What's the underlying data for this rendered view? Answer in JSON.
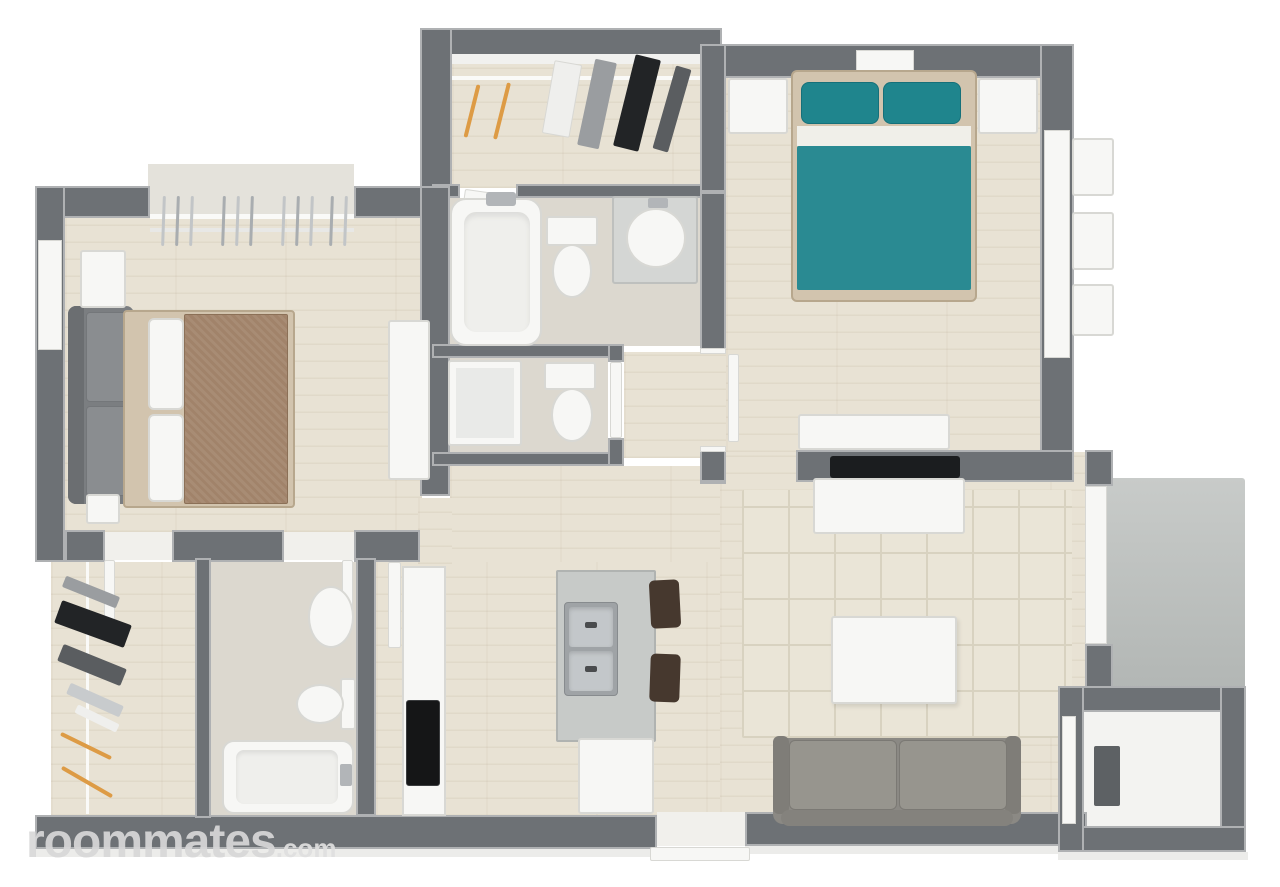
{
  "watermark": {
    "brand": "roommates",
    "suffix": ".com"
  },
  "plan": {
    "style": "3d-top-down-floorplan",
    "rooms": [
      "bedroom-1",
      "bedroom-2",
      "bathroom-1",
      "toilet-room",
      "bathroom-2",
      "walk-in-closet-1",
      "walk-in-closet-2",
      "kitchen",
      "living-room",
      "hallway",
      "patio",
      "storage-room"
    ]
  },
  "colors": {
    "wall": "#6d7175",
    "wallEdge": "rgba(255,255,255,0.45)",
    "woodBase": "#e8e2d4",
    "woodStreak": "rgba(155,135,105,0.10)",
    "bathFloor": "#dcd8cf",
    "alcoveFloor": "#e4e2db",
    "white": "#f7f7f5",
    "whiteBorder": "#d8d8d4",
    "teal": "#2a8a92",
    "tealPillow": "#1f858d",
    "tealBorder": "#15707a",
    "tanFrame": "#d2c4ae",
    "tanBorder": "#b7a78d",
    "duvetBrown": "#a1836a",
    "duvetBorder": "#8b7057",
    "sofaDark": "#7b7e81",
    "sofaDarkBand": "#6b6e71",
    "sofaCushion": "#8a8d90",
    "sofaCushionBorder": "#74777a",
    "livingSofa": "#8b8984",
    "livingCushion": "#97958e",
    "livingCushionBorder": "#7b7974",
    "livingSofaBack": "#84827d",
    "arm": "#7f7d78",
    "stool": "#46382e",
    "steel": "#9fa3a6",
    "steelBorder": "#878b8e",
    "basin": "#c3c7ca",
    "tapDark": "#4a4c4e",
    "islandTop": "#c7cac8",
    "islandBorder": "#b0b3b1",
    "cooktop": "#151617",
    "rug": "#eae5d7",
    "rugLine": "#d8d2c0",
    "patioTop": "#c8cbc9",
    "patioBottom": "#b2b6b4",
    "storageFloor": "#f3f3f1",
    "heater": "#5d6164",
    "clothesOrange": "#dd9b45",
    "clothesBlack": "#222426",
    "clothesDarkGray": "#5a5d60",
    "clothesGray": "#9a9da0",
    "clothesLightGray": "#c8cbcd",
    "clothesWhite": "#efefed",
    "hanger": "#c2c5c7",
    "hangerDark": "#a9adb0",
    "black": "#1b1d1f",
    "bevel": "#ececea",
    "threshold": "#f1f0ec",
    "sheet": "#f0efe9",
    "tubInner": "#efefec",
    "glassShower": "#e9eae8",
    "vanity": "#d4d6d4",
    "vanityBorder": "#bec0be",
    "faucet": "#b2b5b8",
    "railWhite": "#fafaf8",
    "shelfWhite": "#f1f1ef",
    "shelf2": "#e8e8e6",
    "watermark": "#d8d8d8",
    "watermarkSuffix": "#e0e0e0"
  }
}
